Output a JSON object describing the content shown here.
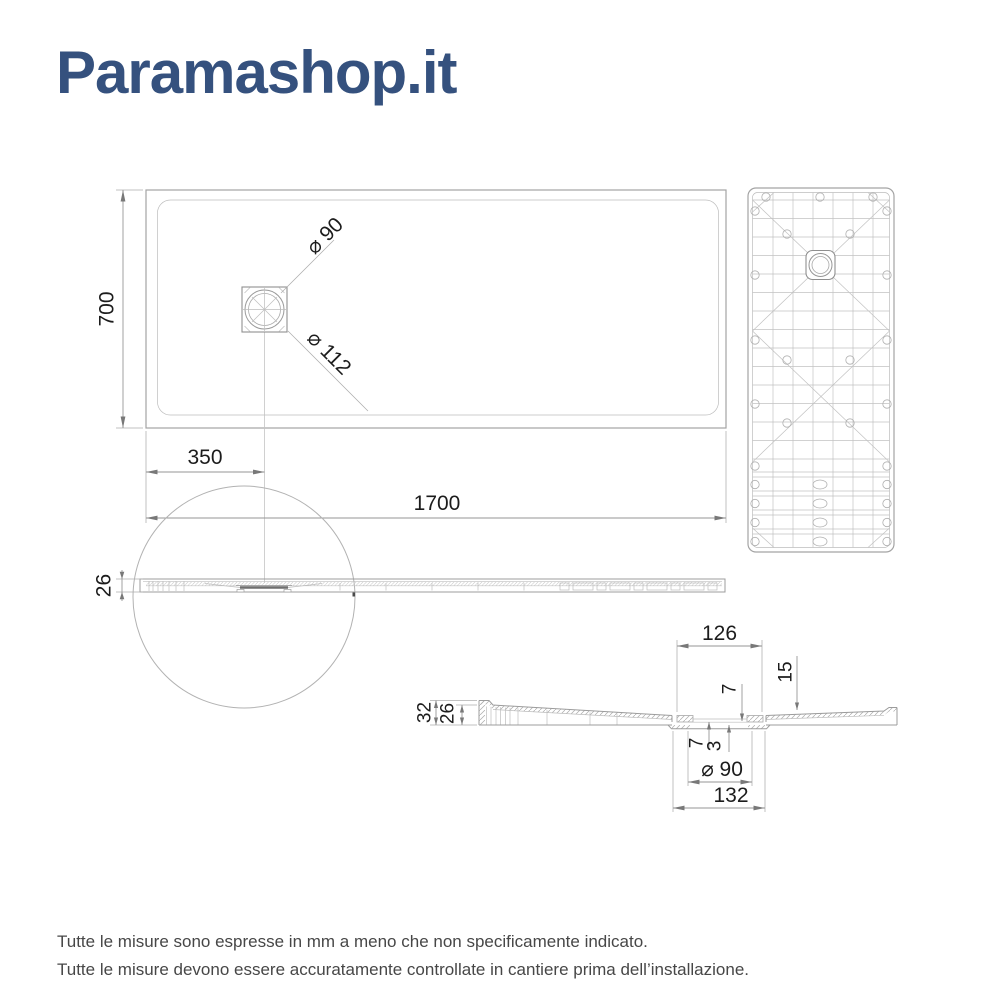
{
  "brand": {
    "name": "Paramashop.it",
    "color": "#35517e"
  },
  "views": {
    "plan": {
      "width": "1700",
      "depth": "700",
      "drain_offset": "350",
      "drain_inner_diameter": "⌀ 90",
      "drain_outer_diameter": "⌀ 112"
    },
    "side": {
      "thickness": "26"
    },
    "section": {
      "recess_width": "126",
      "edge_thickness": "15",
      "seat_depth": "7",
      "total_height": "32",
      "body_height": "26",
      "flange_depth": "7",
      "floor_thickness": "3",
      "drain_diameter": "⌀ 90",
      "flange_width": "132"
    }
  },
  "footer": {
    "line1": "Tutte le misure sono espresse in mm a meno che non specificamente indicato.",
    "line2": "Tutte le misure devono essere accuratamente controllate in cantiere prima dell’installazione."
  }
}
